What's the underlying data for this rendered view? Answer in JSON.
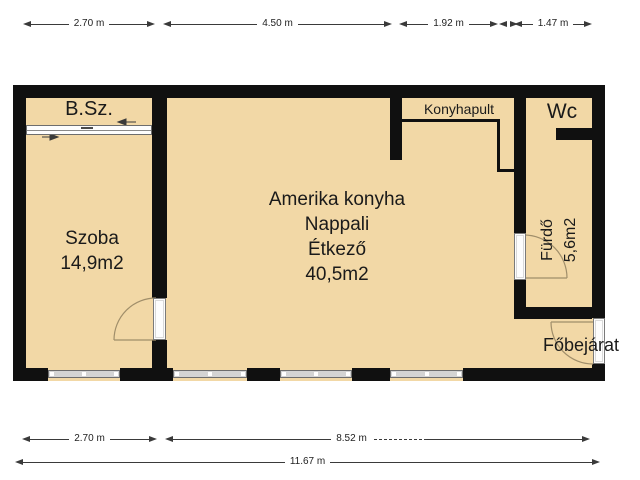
{
  "plan_title": "apartment-floor-plan",
  "rooms": {
    "bsz": {
      "label": "B.Sz."
    },
    "szoba": {
      "label": "Szoba",
      "area": "14,9m2"
    },
    "living": {
      "lines": [
        "Amerika konyha",
        "Nappali",
        "Étkező",
        "40,5m2"
      ]
    },
    "konyhapult": {
      "label": "Konyhapult"
    },
    "wc": {
      "label": "Wc"
    },
    "furdo": {
      "label": "Fürdő",
      "area": "5,6m2"
    },
    "entrance": {
      "label": "Főbejárat"
    }
  },
  "dims": {
    "top1": "2.70 m",
    "top2": "4.50 m",
    "top3": "1.92 m",
    "top4": "1.47 m",
    "bottom1": "2.70 m",
    "bottom2": "8.52 m",
    "total": "11.67 m"
  },
  "colors": {
    "floor": "#f2d8a6",
    "wall": "#101010",
    "window": "#d4d4d4",
    "door_arc": "#a08e6a",
    "dimension": "#3a3a3a",
    "background": "#ffffff"
  }
}
